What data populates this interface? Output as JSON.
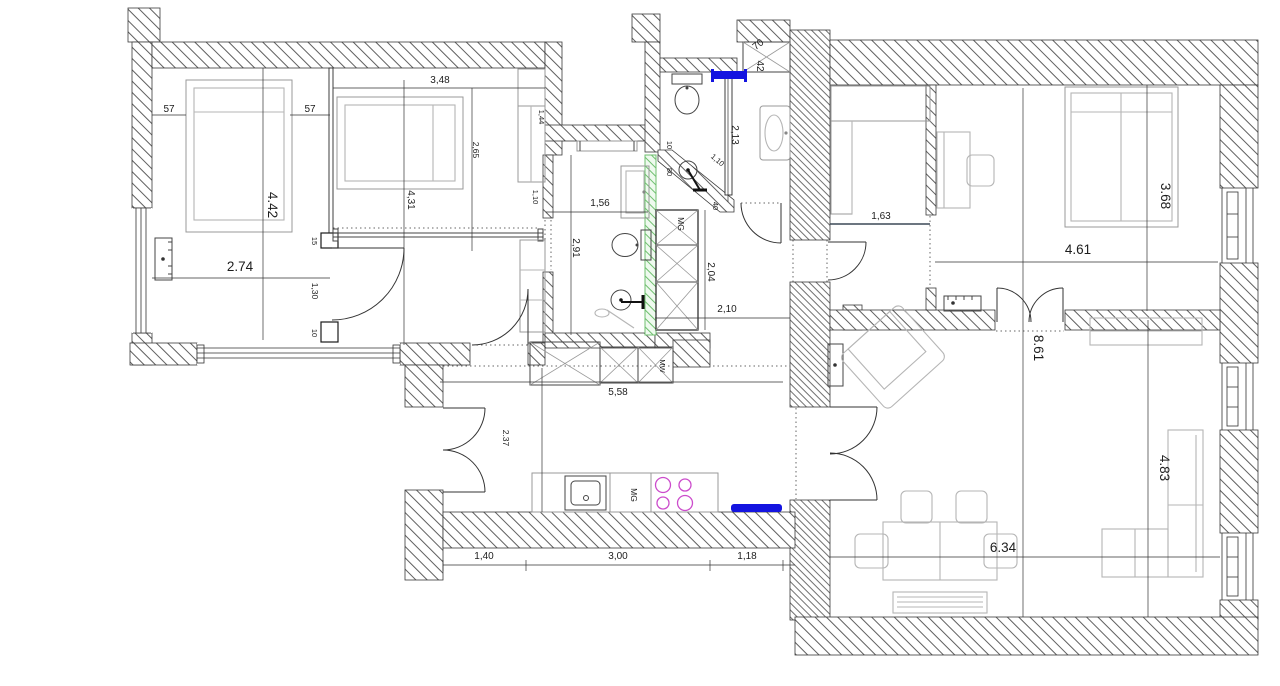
{
  "colors": {
    "highlight_blue": "#1414e0",
    "highlight_green": "#6fbf6f",
    "hob_burner": "#cc4ccc"
  },
  "rooms": {
    "bedroom_left": {
      "width": "2.74",
      "height": "4.42",
      "bed_gap_left": "57",
      "bed_gap_right": "57",
      "door_frame_top": "15",
      "door_width": "1,30",
      "door_frame_bottom": "10"
    },
    "bedroom_middle": {
      "width": "3,48",
      "bed_zone": "2,65",
      "height": "4,31",
      "niche_top": "1,44",
      "niche_mid": "1,10"
    },
    "bathroom": {
      "width": "1,56",
      "height": "2,91"
    },
    "shower": {
      "dim_10": "10",
      "dim_80": "80",
      "dim_diag": "1,10",
      "dim_40": "40"
    },
    "wc": {
      "height": "2,13"
    },
    "entry_cabinet": {
      "width": "70",
      "depth": "42"
    },
    "hallway": {
      "closet_label": "MG",
      "closet_height": "2,04",
      "width": "2,10"
    },
    "kitchen": {
      "run_width": "5,58",
      "entry_depth": "2.37",
      "dishwasher_label": "MG",
      "cabinet_label": "MW",
      "dim_left": "1,40",
      "dim_mid": "3,00",
      "dim_right": "1,18"
    },
    "kids_room": {
      "width": "1,63"
    },
    "bedroom_right": {
      "width": "4.61",
      "bed": "3.68"
    },
    "living_room": {
      "height": "8.61",
      "width": "6.34",
      "right_side": "4.83"
    }
  }
}
